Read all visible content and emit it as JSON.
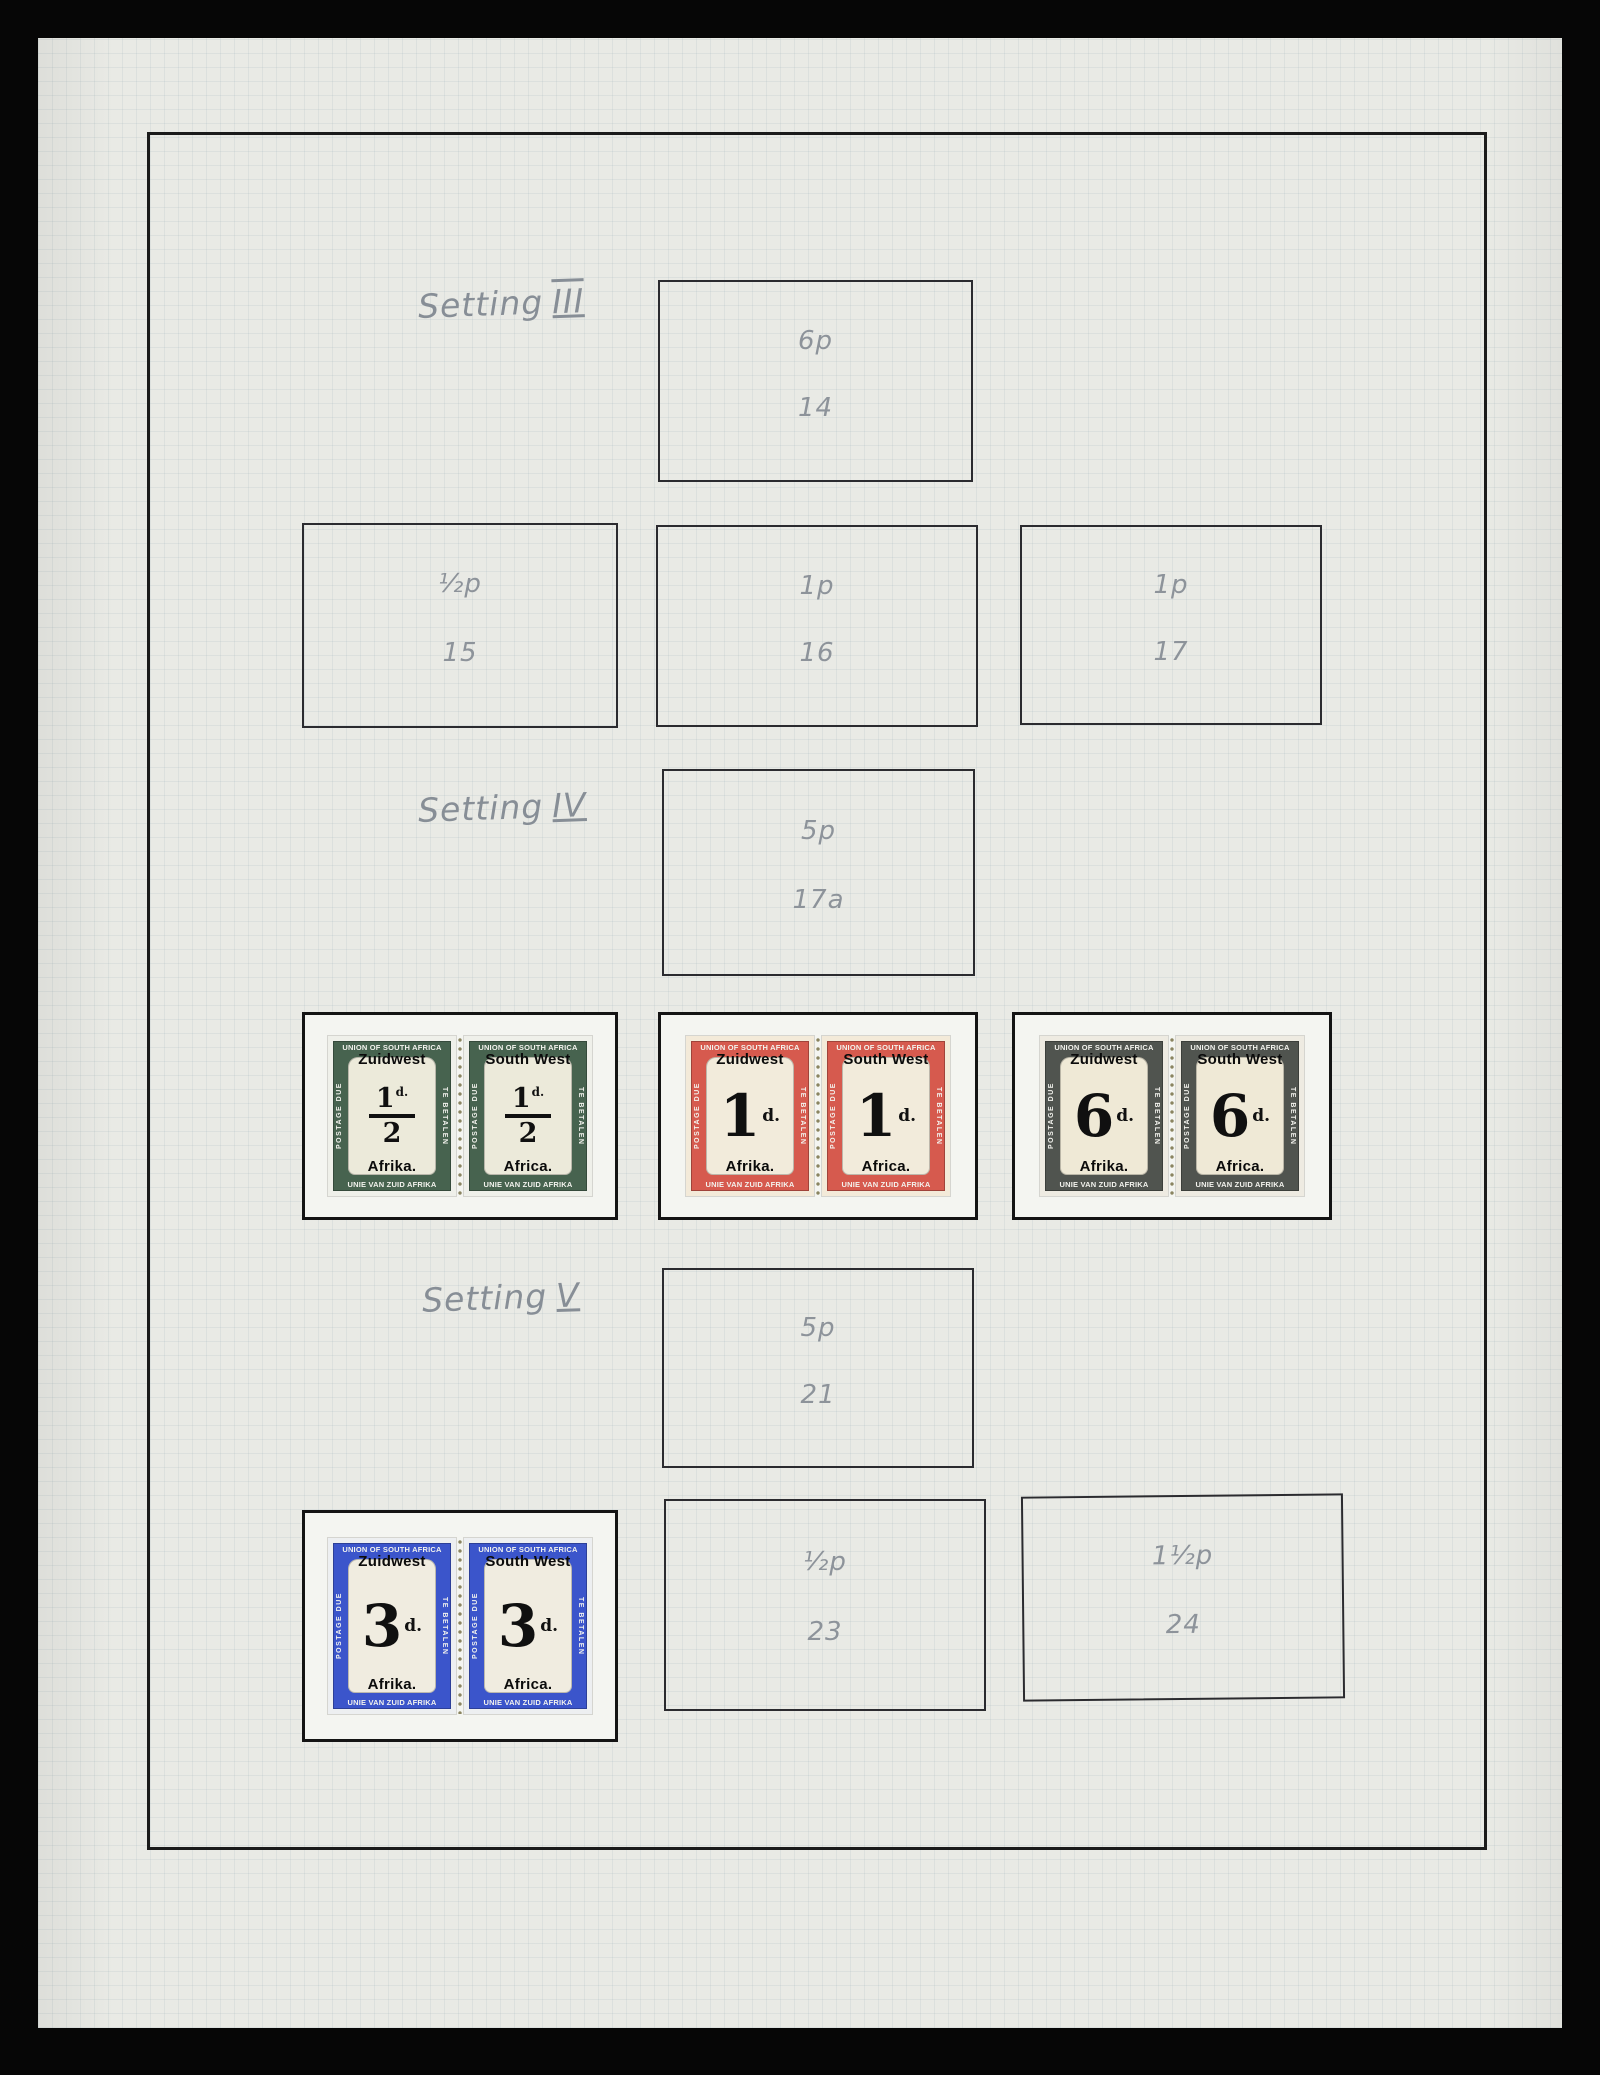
{
  "photo": {
    "background_color": "#060606",
    "paper_color": "#e9eae5",
    "ink_border_color": "#1b1b1b",
    "pencil_color": "#8d939a"
  },
  "sections": {
    "setting3": {
      "label": "Setting",
      "numeral": "III"
    },
    "setting4": {
      "label": "Setting",
      "numeral": "IV"
    },
    "setting5": {
      "label": "Setting",
      "numeral": "V"
    }
  },
  "placeholders": {
    "b14": {
      "denomination": "6p",
      "number": "14"
    },
    "b15": {
      "denomination": "½p",
      "number": "15"
    },
    "b16": {
      "denomination": "1p",
      "number": "16"
    },
    "b17": {
      "denomination": "1p",
      "number": "17"
    },
    "b17a": {
      "denomination": "5p",
      "number": "17a"
    },
    "b21": {
      "denomination": "5p",
      "number": "21"
    },
    "b23": {
      "denomination": "½p",
      "number": "23"
    },
    "b24": {
      "denomination": "1½p",
      "number": "24"
    }
  },
  "stamps": {
    "frame_text": {
      "top": "UNION OF SOUTH AFRICA",
      "bottom": "UNIE VAN ZUID AFRIKA",
      "left": "POSTAGE DUE",
      "right": "TE BETALEN"
    },
    "overprints": {
      "left": {
        "line1": "Zuidwest",
        "line2": "Afrika."
      },
      "right": {
        "line1": "South West",
        "line2": "Africa."
      }
    },
    "pairs": [
      {
        "name": "halfpenny-green",
        "frame_color": "#47634f",
        "paper_color": "#eff0ea",
        "tablet_color": "#eceada",
        "value_style": "fraction",
        "numerator": "1",
        "denominator": "2",
        "unit": "d."
      },
      {
        "name": "one-penny-red",
        "frame_color": "#d65a4e",
        "paper_color": "#f3ead9",
        "tablet_color": "#f2ebdb",
        "value_style": "whole",
        "value": "1",
        "unit": "d."
      },
      {
        "name": "sixpence-grey",
        "frame_color": "#50544f",
        "paper_color": "#eeebe2",
        "tablet_color": "#efe9d6",
        "value_style": "whole",
        "value": "6",
        "unit": "d."
      },
      {
        "name": "threepence-blue",
        "frame_color": "#3b55cb",
        "paper_color": "#edeff1",
        "tablet_color": "#f0ece0",
        "value_style": "whole",
        "value": "3",
        "unit": "d."
      }
    ]
  }
}
